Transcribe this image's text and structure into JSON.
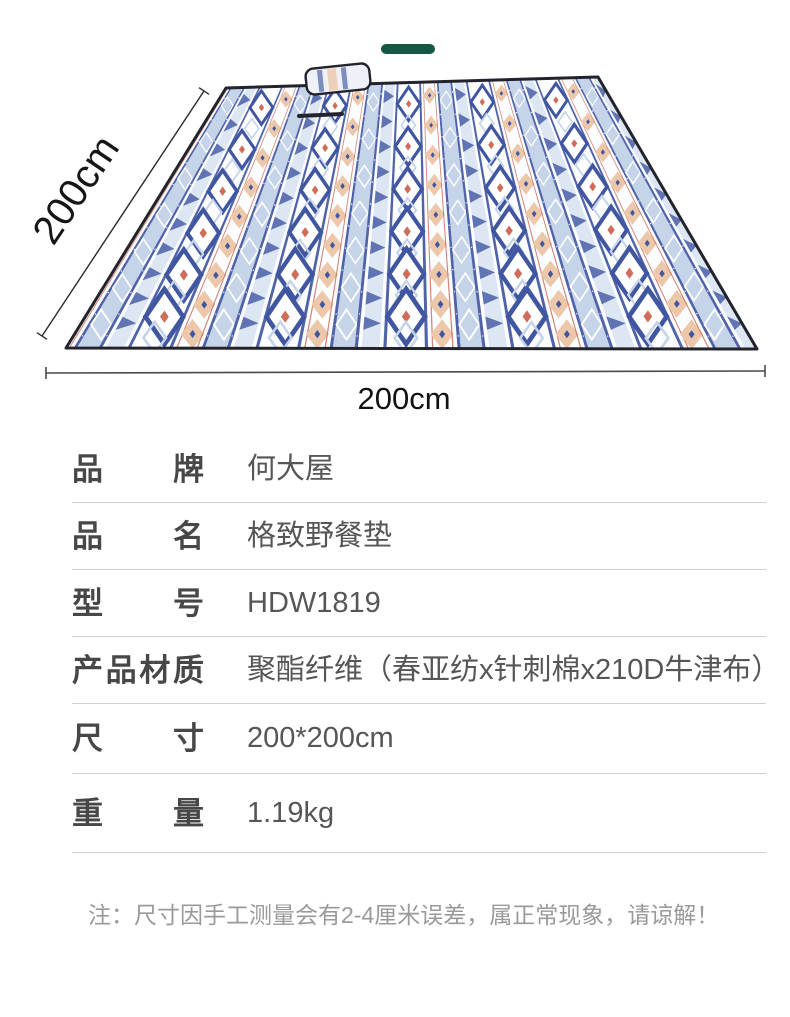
{
  "hero": {
    "accent_dash_color": "#175844",
    "dimensions": {
      "left_label": "200cm",
      "bottom_label": "200cm"
    },
    "mat_palette": {
      "navy": "#4156a1",
      "light_blue": "#c6d4ea",
      "pale_blue": "#dde6f3",
      "peach": "#ecc7a9",
      "red": "#cd6d5a",
      "white": "#fcfdff",
      "trim": "#23232c"
    }
  },
  "spec_table": {
    "rows": [
      {
        "label": "品牌",
        "value": "何大屋"
      },
      {
        "label": "品名",
        "value": "格致野餐垫"
      },
      {
        "label": "型号",
        "value": "HDW1819"
      },
      {
        "label": "产品材质",
        "value": "聚酯纤维（春亚纺x针刺棉x210D牛津布）"
      },
      {
        "label": "尺寸",
        "value": "200*200cm"
      },
      {
        "label": "重量",
        "value": "1.19kg"
      }
    ]
  },
  "note": {
    "text": "注：尺寸因手工测量会有2-4厘米误差，属正常现象，请谅解！"
  }
}
